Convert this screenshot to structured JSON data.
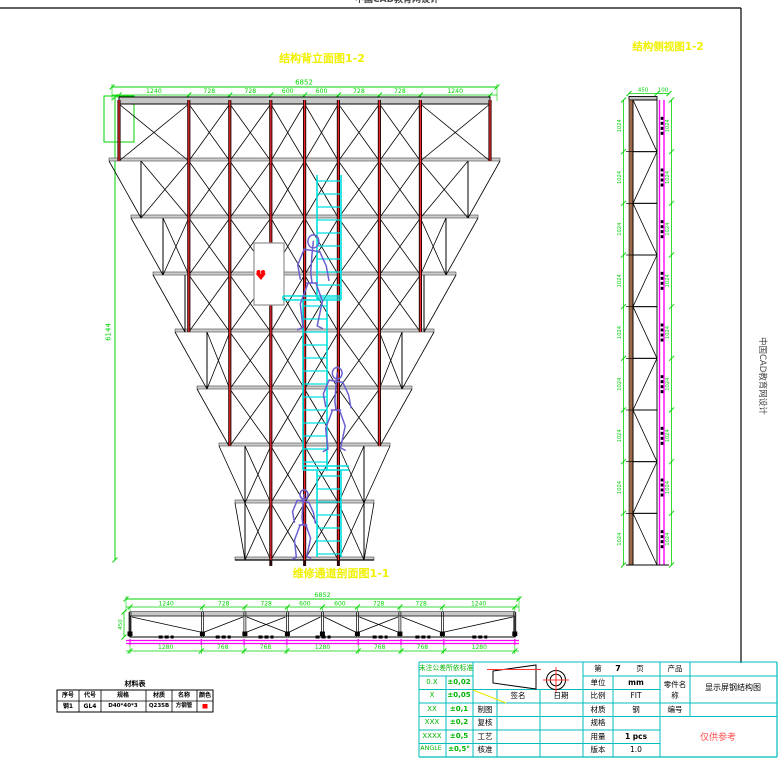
{
  "watermark": {
    "top": "中国CAD教育网设计",
    "side": "中国CAD教育网设计"
  },
  "titles": {
    "elevation": "结构背立面图1-2",
    "side_view": "结构侧视图1-2",
    "section": "维修通道剖面图1-1"
  },
  "colors": {
    "dim": "#00d400",
    "magenta": "#ff00ff",
    "cyan": "#00e0e0",
    "yellow": "#f0f000",
    "maroon": "#2b0a0a",
    "maroon_core": "#ff2a2a",
    "red": "#ff0000",
    "figure": "#6a5fd0",
    "beam": "#c6c6c6",
    "block_line": "#00bcbc"
  },
  "elevation": {
    "overall": "6852",
    "segments": [
      "1240",
      "728",
      "728",
      "600",
      "600",
      "728",
      "728",
      "1240"
    ],
    "height": "6144"
  },
  "side_view": {
    "top_dims": [
      "450",
      "100"
    ],
    "left_dims": [
      "1024",
      "1024",
      "1024",
      "1024",
      "1024",
      "1024",
      "1024",
      "1024",
      "1024"
    ],
    "right_dims": [
      "1024",
      "1024",
      "1024",
      "1024",
      "1024",
      "1024",
      "1024",
      "1024",
      "1024"
    ]
  },
  "section": {
    "overall": "6852",
    "segments": [
      "1240",
      "728",
      "728",
      "600",
      "600",
      "728",
      "728",
      "1240"
    ],
    "bottom_segments": [
      "1280",
      "768",
      "768",
      "1280",
      "768",
      "768",
      "1280"
    ],
    "height": "450"
  },
  "material_table": {
    "title": "材料表",
    "headers": [
      "序号",
      "代号",
      "规格",
      "材质",
      "名称",
      "颜色"
    ],
    "row": {
      "cells": [
        "钢1",
        "GL4",
        "D40*40*3",
        "Q235B",
        "方钢管"
      ],
      "color": "#ff0000"
    }
  },
  "title_block": {
    "tolerance_header": "未注公差所依标准",
    "tolerances": [
      {
        "label": "0.X",
        "value": "±0,02"
      },
      {
        "label": "X",
        "value": "±0,05"
      },
      {
        "label": "XX",
        "value": "±0,1"
      },
      {
        "label": "XXX",
        "value": "±0,2"
      },
      {
        "label": "XXXX",
        "value": "±0,5"
      },
      {
        "label": "ANGLE",
        "value": "±0,5°"
      }
    ],
    "sign_header": "签名",
    "date_header": "日期",
    "approval_rows": [
      "制图",
      "复核",
      "工艺",
      "核准"
    ],
    "page": {
      "prefix": "第",
      "number": "7",
      "suffix": "页"
    },
    "info_rows": [
      {
        "label": "单位",
        "value": "mm"
      },
      {
        "label": "比例",
        "value": "FIT"
      },
      {
        "label": "材质",
        "value": "钢"
      },
      {
        "label": "规格",
        "value": ""
      },
      {
        "label": "用量",
        "value": "1 pcs"
      },
      {
        "label": "版本",
        "value": "1.0"
      }
    ],
    "product_label": "产品",
    "part_label": "零件名称",
    "part_name": "显示屏钢结构图",
    "number_label": "编号",
    "reference_note": "仅供参考"
  }
}
